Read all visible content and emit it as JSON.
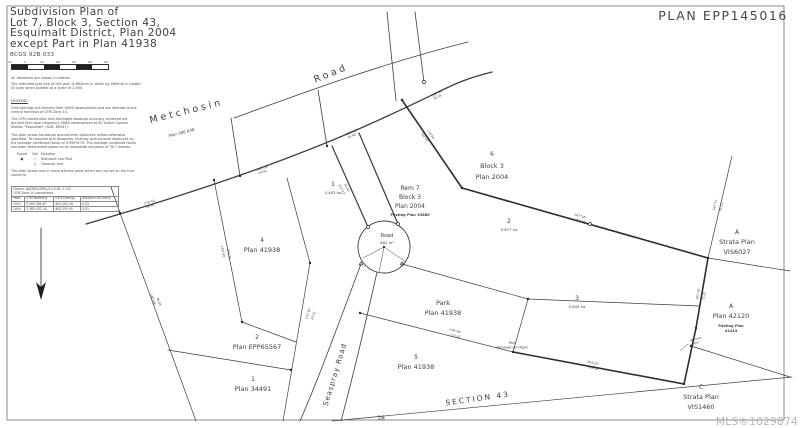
{
  "header": {
    "title_lines": [
      "Subdivision Plan of",
      "Lot 7, Block 3, Section 43,",
      "Esquimalt District, Plan 2004",
      "except Part in Plan 41938"
    ],
    "bcgs": "BCGS 92B.033",
    "plan_number": "PLAN EPP145016"
  },
  "scale_bar": {
    "ticks": [
      "10",
      "0",
      "10",
      "20",
      "30",
      "40",
      "50"
    ],
    "note1": "All distances are shown in metres.",
    "note2": "The intended plot size of this plan is 864mm in width by 560mm in height (D size) when plotted at a scale of 1:500."
  },
  "legend": {
    "heading": "LEGEND:",
    "paragraphs": [
      "Grid bearings are derived from GNSS observations and are referred to the central meridian of UTM Zone 10.",
      "The UTM coordinates and estimated absolute accuracy achieved are derived from dual frequency GNSS observations to BC Active Control Station \"Esquimalt\" (ACB: 80047).",
      "This plan shows horizontal ground-level distances unless otherwise specified. To compute grid distances, multiply ground-level distances by the average combined factor of 0.9999170. The average combined factor has been determined based on an ellipsoidal elevation of 30.7 metres."
    ],
    "symbols": {
      "header": [
        "Found",
        "Set",
        "Denotes"
      ],
      "rows": [
        [
          "●",
          "○",
          "Standard Iron Post"
        ],
        [
          "",
          "△",
          "Traverse Hub"
        ]
      ]
    },
    "witness_note": "This plan shows one or more witness posts which are not set on the true corner(s)."
  },
  "coordinate_table": {
    "datum_line1": "Datum: NAD83(CSRS)/4.0.0.BC.1.GVI",
    "datum_line2": "UTM Zone 10 coordinates",
    "columns": [
      "Point",
      "UTM Northing",
      "UTM Easting",
      "Absolute Accuracy"
    ],
    "rows": [
      [
        "1002",
        "5,365,385.67",
        "463,263.28",
        "0.03"
      ],
      [
        "1004",
        "5,365,432.34",
        "463,259.90",
        "0.03"
      ]
    ]
  },
  "watermark": "MLS®1029874",
  "survey": {
    "labels": [
      {
        "t": "Metchosin",
        "x": 187,
        "y": 114,
        "s": 9.5,
        "r": -14,
        "sp": 3
      },
      {
        "t": "Road",
        "x": 332,
        "y": 76,
        "s": 9.5,
        "r": -22,
        "sp": 3
      },
      {
        "t": "Plan 380 R/W",
        "x": 182,
        "y": 134,
        "s": 4,
        "r": -14
      },
      {
        "t": "1",
        "x": 333,
        "y": 186,
        "s": 6
      },
      {
        "t": "0.403 ha",
        "x": 333,
        "y": 194,
        "s": 3.8
      },
      {
        "t": "Rem 7",
        "x": 410,
        "y": 190,
        "s": 6
      },
      {
        "t": "Block 3",
        "x": 410,
        "y": 199,
        "s": 6
      },
      {
        "t": "Plan 2004",
        "x": 410,
        "y": 208,
        "s": 6
      },
      {
        "t": "Posting Plan 33860",
        "x": 410,
        "y": 216,
        "s": 3.6,
        "w": "bold"
      },
      {
        "t": "6",
        "x": 492,
        "y": 156,
        "s": 6
      },
      {
        "t": "Block 3",
        "x": 492,
        "y": 168,
        "s": 6.5
      },
      {
        "t": "Plan 2004",
        "x": 492,
        "y": 179,
        "s": 6.5
      },
      {
        "t": "2",
        "x": 509,
        "y": 223,
        "s": 6
      },
      {
        "t": "0.877 ha",
        "x": 509,
        "y": 231,
        "s": 3.8
      },
      {
        "t": "4",
        "x": 262,
        "y": 242,
        "s": 6
      },
      {
        "t": "Plan 41938",
        "x": 262,
        "y": 252,
        "s": 6.5
      },
      {
        "t": "Road",
        "x": 387,
        "y": 237,
        "s": 5
      },
      {
        "t": "862 m²",
        "x": 387,
        "y": 244,
        "s": 3.8
      },
      {
        "t": "Park",
        "x": 443,
        "y": 305,
        "s": 6.5
      },
      {
        "t": "Plan 41938",
        "x": 443,
        "y": 315,
        "s": 6.5
      },
      {
        "t": "3",
        "x": 577,
        "y": 300,
        "s": 6
      },
      {
        "t": "0.843 ha",
        "x": 577,
        "y": 308,
        "s": 3.8
      },
      {
        "t": "5",
        "x": 416,
        "y": 359,
        "s": 6
      },
      {
        "t": "Plan 41938",
        "x": 416,
        "y": 369,
        "s": 6.5
      },
      {
        "t": "2",
        "x": 257,
        "y": 339,
        "s": 6
      },
      {
        "t": "Plan EPP65567",
        "x": 257,
        "y": 349,
        "s": 6.5
      },
      {
        "t": "1",
        "x": 253,
        "y": 381,
        "s": 6
      },
      {
        "t": "Plan 34491",
        "x": 253,
        "y": 391,
        "s": 6.5
      },
      {
        "t": "A",
        "x": 737,
        "y": 234,
        "s": 6
      },
      {
        "t": "Strata Plan",
        "x": 737,
        "y": 244,
        "s": 6.5
      },
      {
        "t": "VIS6027",
        "x": 737,
        "y": 254,
        "s": 6.5
      },
      {
        "t": "A",
        "x": 731,
        "y": 308,
        "s": 6
      },
      {
        "t": "Plan 42120",
        "x": 731,
        "y": 318,
        "s": 6.5
      },
      {
        "t": "Posting Plan",
        "x": 731,
        "y": 327,
        "s": 3.6,
        "w": "bold"
      },
      {
        "t": "41413",
        "x": 731,
        "y": 332,
        "s": 3.6,
        "w": "bold"
      },
      {
        "t": "C",
        "x": 701,
        "y": 389,
        "s": 6
      },
      {
        "t": "Strata Plan",
        "x": 701,
        "y": 399,
        "s": 6.5
      },
      {
        "t": "VIS1460",
        "x": 701,
        "y": 409,
        "s": 6.5
      },
      {
        "t": "Seaspray Road",
        "x": 337,
        "y": 375,
        "s": 7,
        "r": -73,
        "sp": 1
      },
      {
        "t": "SECTION 43",
        "x": 478,
        "y": 401,
        "s": 7.5,
        "r": -8,
        "sp": 2
      },
      {
        "t": "18",
        "x": 381,
        "y": 420,
        "s": 6
      },
      {
        "t": "Part",
        "x": 512,
        "y": 344,
        "s": 3.2
      },
      {
        "t": "Removed and Road",
        "x": 512,
        "y": 348.5,
        "s": 3.2
      },
      {
        "t": "Witness",
        "x": 696,
        "y": 340,
        "s": 3,
        "r": -15
      },
      {
        "t": "Post",
        "x": 696,
        "y": 344,
        "s": 3,
        "r": -15
      },
      {
        "t": "278°54'",
        "x": 150,
        "y": 203,
        "s": 3,
        "r": -15
      },
      {
        "t": "38.10",
        "x": 150,
        "y": 207,
        "s": 3,
        "r": -15
      },
      {
        "t": "285°36'",
        "x": 263,
        "y": 169,
        "s": 3,
        "r": -18
      },
      {
        "t": "24.66",
        "x": 263,
        "y": 173,
        "s": 3,
        "r": -18
      },
      {
        "t": "293°12'",
        "x": 352,
        "y": 133,
        "s": 3,
        "r": -24
      },
      {
        "t": "30.48",
        "x": 352,
        "y": 137,
        "s": 3,
        "r": -24
      },
      {
        "t": "297°45'",
        "x": 438,
        "y": 94,
        "s": 3,
        "r": -27
      },
      {
        "t": "35.05",
        "x": 438,
        "y": 98,
        "s": 3,
        "r": -27
      },
      {
        "t": "153°22'",
        "x": 341,
        "y": 190,
        "s": 3,
        "r": 63
      },
      {
        "t": "26.50",
        "x": 346,
        "y": 188,
        "s": 3,
        "r": 63
      },
      {
        "t": "168°40'",
        "x": 222,
        "y": 252,
        "s": 3,
        "r": 79
      },
      {
        "t": "104.23",
        "x": 228,
        "y": 254,
        "s": 3,
        "r": 79
      },
      {
        "t": "287°16'",
        "x": 580,
        "y": 217,
        "s": 3,
        "r": 16
      },
      {
        "t": "259.08",
        "x": 580,
        "y": 222,
        "s": 3,
        "r": 16
      },
      {
        "t": "185°30'",
        "x": 699,
        "y": 294,
        "s": 3,
        "r": -80
      },
      {
        "t": "72.41",
        "x": 705,
        "y": 296,
        "s": 3,
        "r": -80
      },
      {
        "t": "279°58'",
        "x": 455,
        "y": 332,
        "s": 3,
        "r": 13
      },
      {
        "t": "115.82",
        "x": 455,
        "y": 337,
        "s": 3,
        "r": 13
      },
      {
        "t": "283°07'",
        "x": 593,
        "y": 364,
        "s": 3,
        "r": 13
      },
      {
        "t": "169.16",
        "x": 593,
        "y": 369,
        "s": 3,
        "r": 13
      },
      {
        "t": "172°50'",
        "x": 309,
        "y": 314,
        "s": 3,
        "r": -73
      },
      {
        "t": "20.12",
        "x": 314,
        "y": 316,
        "s": 3,
        "r": -73
      },
      {
        "t": "160°04'",
        "x": 152,
        "y": 300,
        "s": 3,
        "r": 70
      },
      {
        "t": "46.85",
        "x": 158,
        "y": 302,
        "s": 3,
        "r": 70
      },
      {
        "t": "152°47'",
        "x": 424,
        "y": 138,
        "s": 3,
        "r": 56
      },
      {
        "t": "116.90",
        "x": 430,
        "y": 135,
        "s": 3,
        "r": 56
      },
      {
        "t": "167°11'",
        "x": 716,
        "y": 205,
        "s": 3,
        "r": -77
      },
      {
        "t": "41.15",
        "x": 722,
        "y": 207,
        "s": 3,
        "r": -77
      }
    ]
  }
}
